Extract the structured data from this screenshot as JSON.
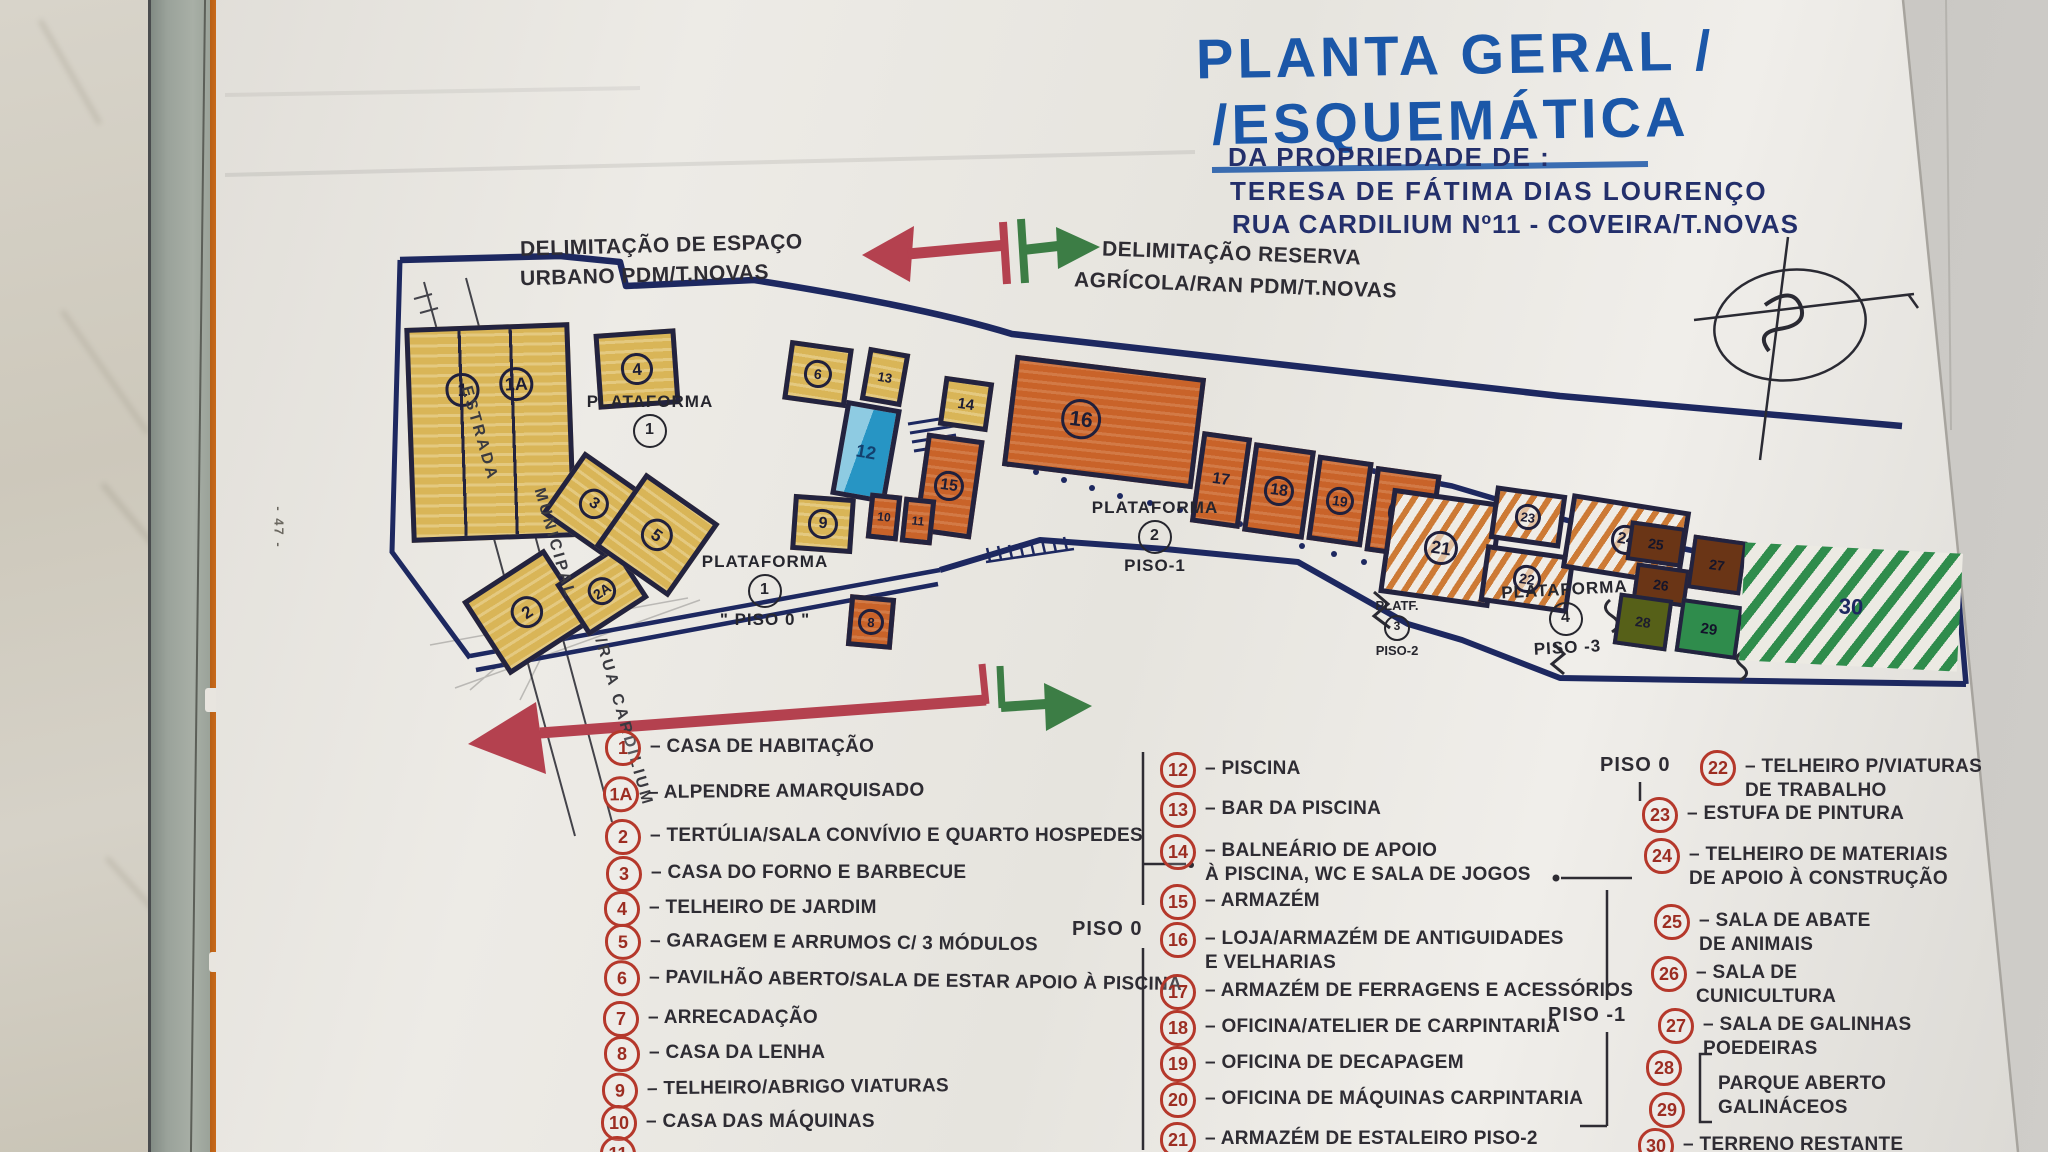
{
  "page": {
    "margin_number": "- 47 -"
  },
  "title": {
    "line1": "PLANTA GERAL /",
    "line2": "/ESQUEMÁTICA",
    "line3": "DA PROPRIEDADE DE :",
    "line4": "TERESA DE FÁTIMA DIAS LOURENÇO",
    "line5": "RUA CARDILIUM Nº11 - COVEIRA/T.NOVAS"
  },
  "annotations": {
    "urban_line1": "DELIMITAÇÃO DE ESPAÇO",
    "urban_line2": "URBANO PDM/T.NOVAS",
    "reserve_line1": "DELIMITAÇÃO RESERVA",
    "reserve_line2": "AGRÍCOLA/RAN PDM/T.NOVAS",
    "road_line1": "ESTRADA",
    "road_line2": "MUNICIPAL",
    "road_line3": "/RUA CARDILIUM"
  },
  "plan": {
    "platforms": [
      {
        "name": "PLATAFORMA",
        "num": "1",
        "piso": ""
      },
      {
        "name": "PLATAFORMA",
        "num": "1",
        "piso": "\" PISO 0 \""
      },
      {
        "name": "PLATAFORMA",
        "num": "2",
        "piso": "PISO-1"
      },
      {
        "name": "PLATF.",
        "num": "3",
        "piso": "PISO-2"
      },
      {
        "name": "PLATAFORMA",
        "num": "4",
        "piso": "PISO -3"
      }
    ],
    "buildings": [
      {
        "label": "1"
      },
      {
        "label": "1A"
      },
      {
        "label": "2"
      },
      {
        "label": "2A"
      },
      {
        "label": "3"
      },
      {
        "label": "5"
      },
      {
        "label": "4"
      },
      {
        "label": "6"
      },
      {
        "label": "13"
      },
      {
        "label": "12"
      },
      {
        "label": "14"
      },
      {
        "label": "15"
      },
      {
        "label": "16"
      },
      {
        "label": "17"
      },
      {
        "label": "18"
      },
      {
        "label": "19"
      },
      {
        "label": "20"
      },
      {
        "label": "21"
      },
      {
        "label": "22"
      },
      {
        "label": "23"
      },
      {
        "label": "24"
      },
      {
        "label": "25"
      },
      {
        "label": "26"
      },
      {
        "label": "27"
      },
      {
        "label": "28"
      },
      {
        "label": "29"
      },
      {
        "label": "30"
      },
      {
        "label": "8"
      },
      {
        "label": "9"
      },
      {
        "label": "10"
      },
      {
        "label": "11"
      }
    ]
  },
  "legend": {
    "piso_mid": "PISO 0",
    "piso_right_top": "PISO 0",
    "piso_right_mid": "PISO -1",
    "col1": [
      {
        "num": "1",
        "line1": "– CASA DE HABITAÇÃO",
        "line2": ""
      },
      {
        "num": "1A",
        "line1": "– ALPENDRE AMARQUISADO",
        "line2": ""
      },
      {
        "num": "2",
        "line1": "– TERTÚLIA/SALA CONVÍVIO E QUARTO HOSPEDES",
        "line2": ""
      },
      {
        "num": "3",
        "line1": "– CASA DO FORNO E BARBECUE",
        "line2": ""
      },
      {
        "num": "4",
        "line1": "– TELHEIRO DE JARDIM",
        "line2": ""
      },
      {
        "num": "5",
        "line1": "– GARAGEM E ARRUMOS C/ 3 MÓDULOS",
        "line2": ""
      },
      {
        "num": "6",
        "line1": "– PAVILHÃO ABERTO/SALA DE ESTAR APOIO À PISCINA",
        "line2": ""
      },
      {
        "num": "7",
        "line1": "– ARRECADAÇÃO",
        "line2": ""
      },
      {
        "num": "8",
        "line1": "– CASA DA LENHA",
        "line2": ""
      },
      {
        "num": "9",
        "line1": "– TELHEIRO/ABRIGO VIATURAS",
        "line2": ""
      },
      {
        "num": "10",
        "line1": "– CASA DAS MÁQUINAS",
        "line2": ""
      },
      {
        "num": "11",
        "line1": "",
        "line2": ""
      }
    ],
    "col2": [
      {
        "num": "12",
        "line1": "– PISCINA",
        "line2": ""
      },
      {
        "num": "13",
        "line1": "– BAR DA PISCINA",
        "line2": ""
      },
      {
        "num": "14",
        "line1": "– BALNEÁRIO DE APOIO",
        "line2": "À PISCINA, WC E SALA DE JOGOS"
      },
      {
        "num": "15",
        "line1": "– ARMAZÉM",
        "line2": ""
      },
      {
        "num": "16",
        "line1": "– LOJA/ARMAZÉM DE ANTIGUIDADES",
        "line2": "E VELHARIAS"
      },
      {
        "num": "17",
        "line1": "– ARMAZÉM DE FERRAGENS E ACESSÓRIOS",
        "line2": ""
      },
      {
        "num": "18",
        "line1": "– OFICINA/ATELIER DE CARPINTARIA",
        "line2": ""
      },
      {
        "num": "19",
        "line1": "– OFICINA DE DECAPAGEM",
        "line2": ""
      },
      {
        "num": "20",
        "line1": "– OFICINA DE MÁQUINAS CARPINTARIA",
        "line2": ""
      },
      {
        "num": "21",
        "line1": "– ARMAZÉM DE ESTALEIRO PISO-2",
        "line2": ""
      }
    ],
    "col3": [
      {
        "num": "22",
        "line1": "– TELHEIRO P/VIATURAS",
        "line2": "DE TRABALHO"
      },
      {
        "num": "23",
        "line1": "– ESTUFA DE PINTURA",
        "line2": ""
      },
      {
        "num": "24",
        "line1": "– TELHEIRO DE MATERIAIS",
        "line2": "DE APOIO À CONSTRUÇÃO"
      },
      {
        "num": "25",
        "line1": "– SALA DE ABATE",
        "line2": "DE ANIMAIS"
      },
      {
        "num": "26",
        "line1": "– SALA DE",
        "line2": "CUNICULTURA"
      },
      {
        "num": "27",
        "line1": "– SALA DE GALINHAS",
        "line2": "POEDEIRAS"
      },
      {
        "num": "28",
        "line1": "",
        "line2": ""
      },
      {
        "num": "29",
        "line1": "PARQUE ABERTO",
        "line2": "GALINÁCEOS"
      },
      {
        "num": "30",
        "line1": "– TERRENO RESTANTE",
        "line2": ""
      }
    ]
  },
  "colors": {
    "title_blue": "#1b57a8",
    "ink_navy": "#1d2860",
    "ink_black": "#2e2c33",
    "legend_red": "#b5382b",
    "arrow_red": "#b4414f",
    "arrow_green": "#3c7d45",
    "building_yellow": "#d9b557",
    "building_orange": "#c96329",
    "pool_blue": "#2795c4",
    "green": "#2f8c4c",
    "brown": "#6a3516",
    "olive": "#566018"
  }
}
